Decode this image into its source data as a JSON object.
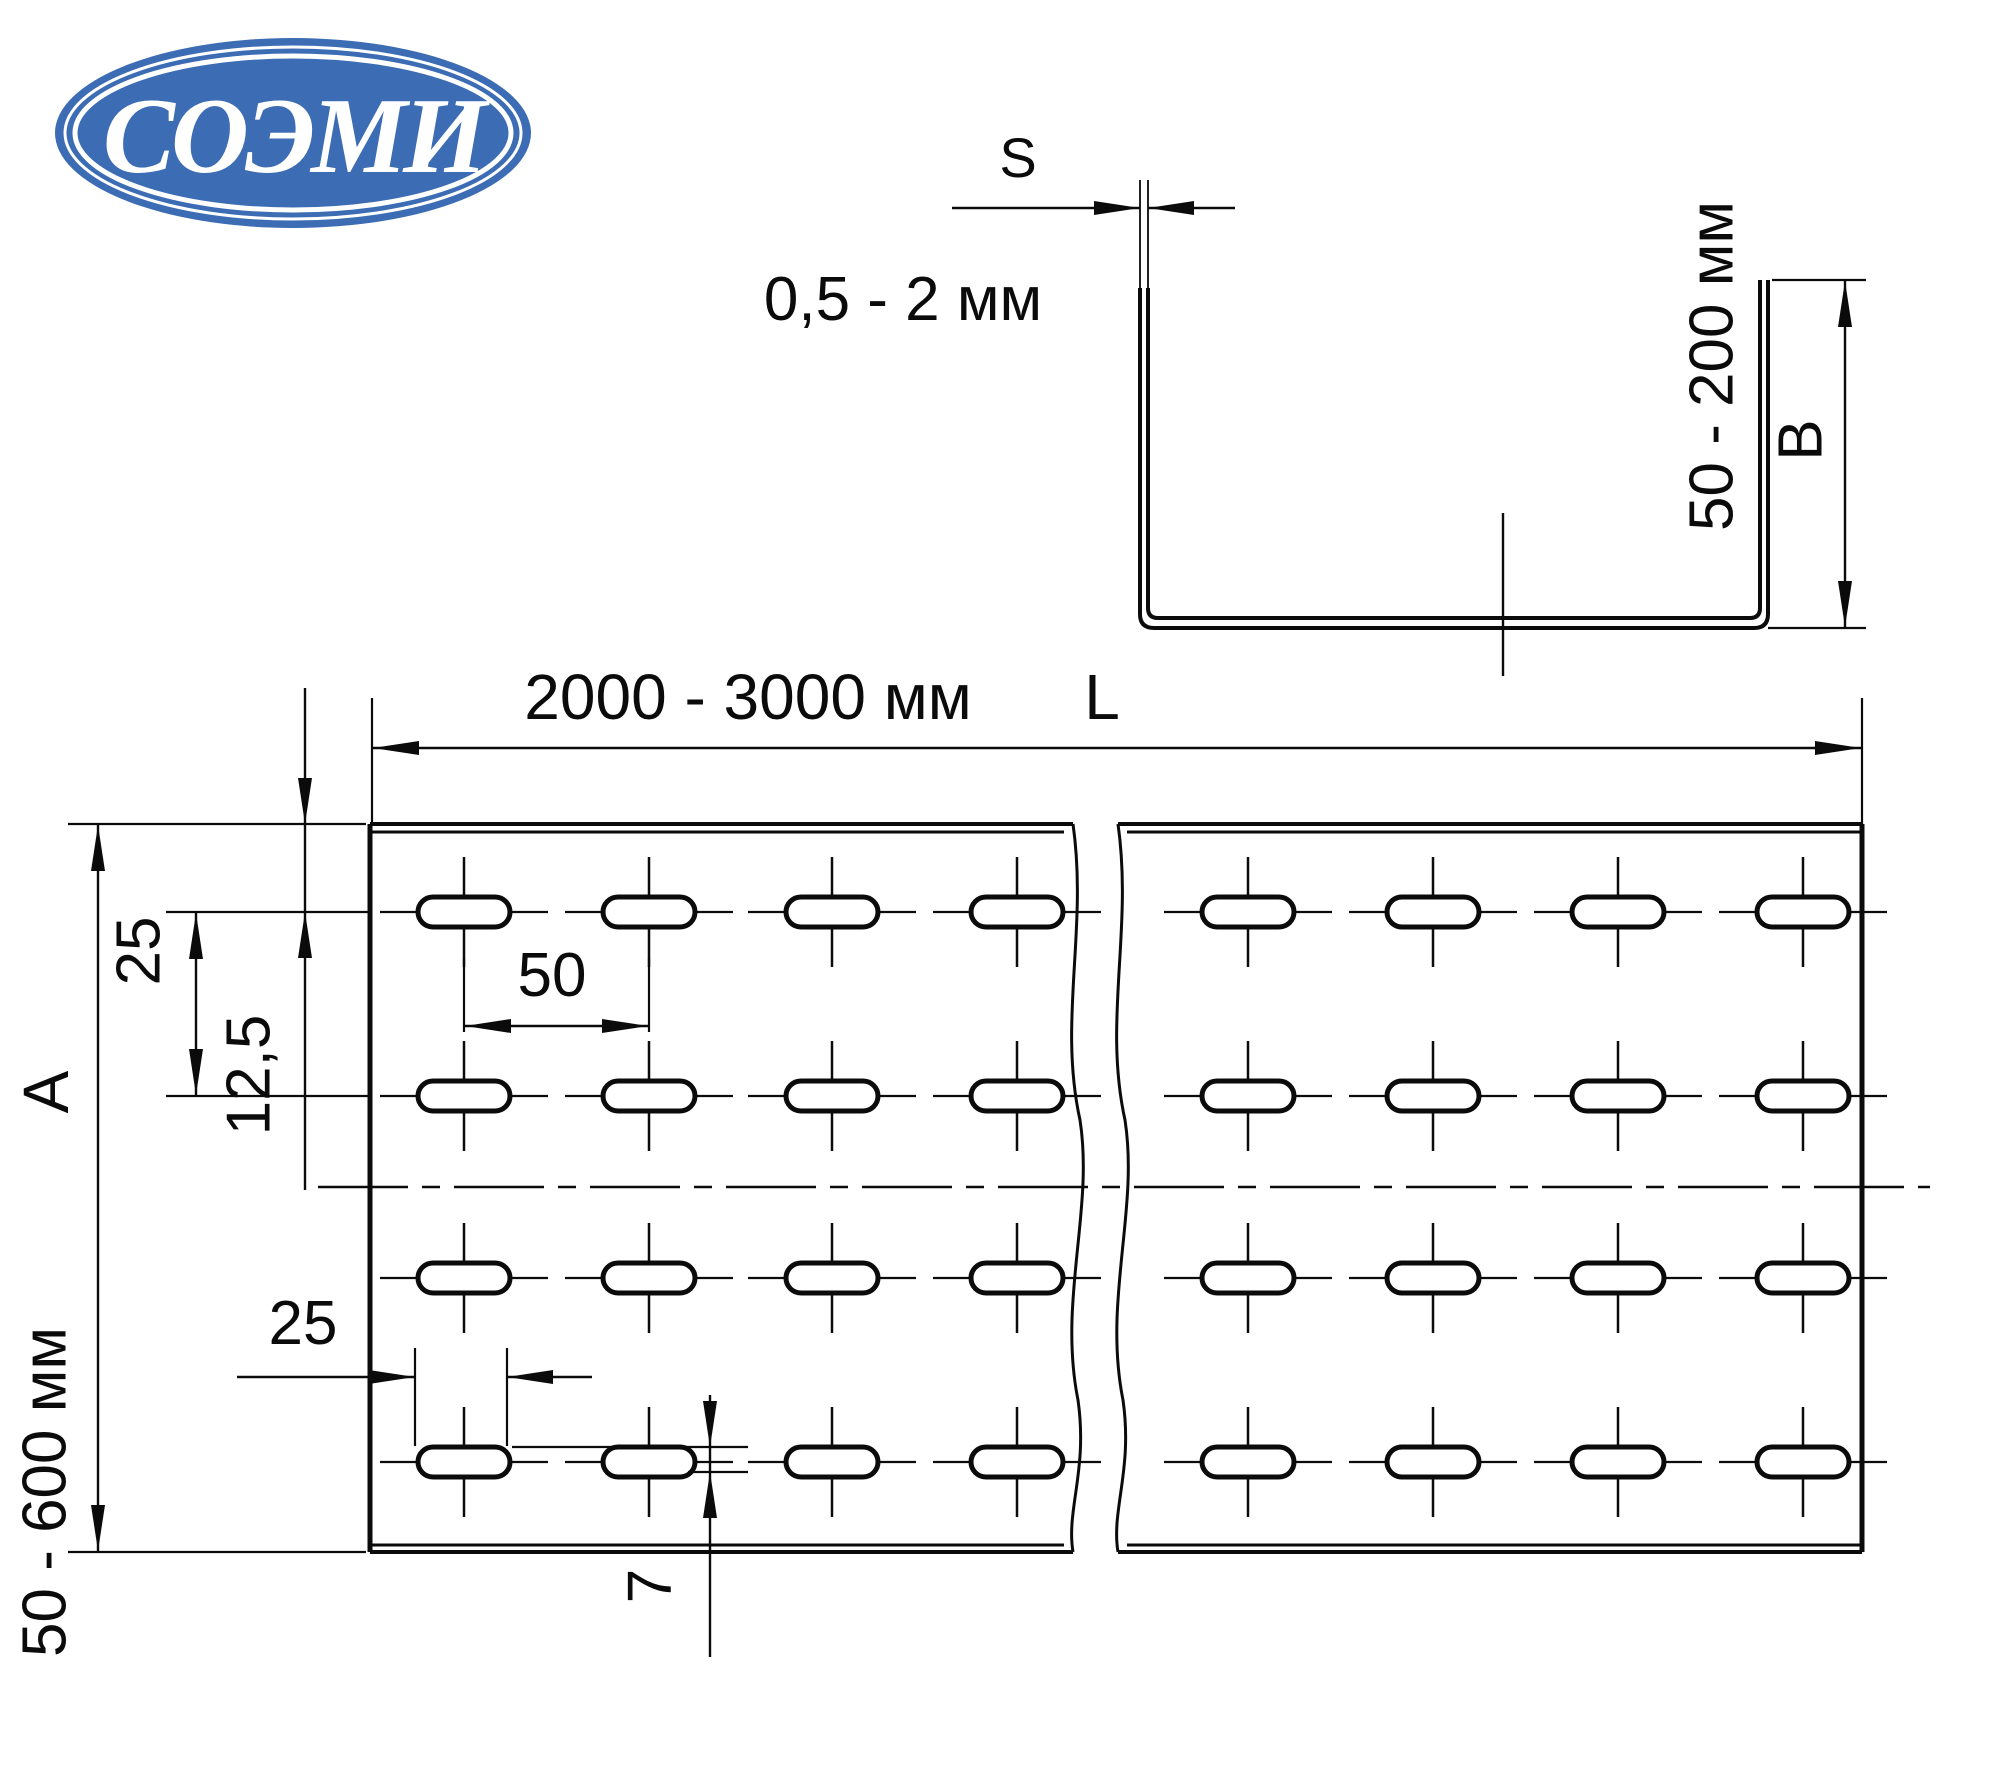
{
  "logo": {
    "text": "СОЭМИ",
    "color": "#3c6cb4"
  },
  "cross_section": {
    "thickness_label": "S",
    "thickness_value": "0,5 - 2 мм",
    "side_height_value": "50 - 200 мм",
    "side_height_label": "B"
  },
  "plan": {
    "length_value": "2000 - 3000 мм",
    "length_label": "L",
    "width_label": "A",
    "width_value": "50 - 600 мм",
    "row_spacing": "25",
    "first_row_offset": "12,5",
    "slot_column_spacing": "50",
    "slot_length": "25",
    "slot_width": "7"
  }
}
